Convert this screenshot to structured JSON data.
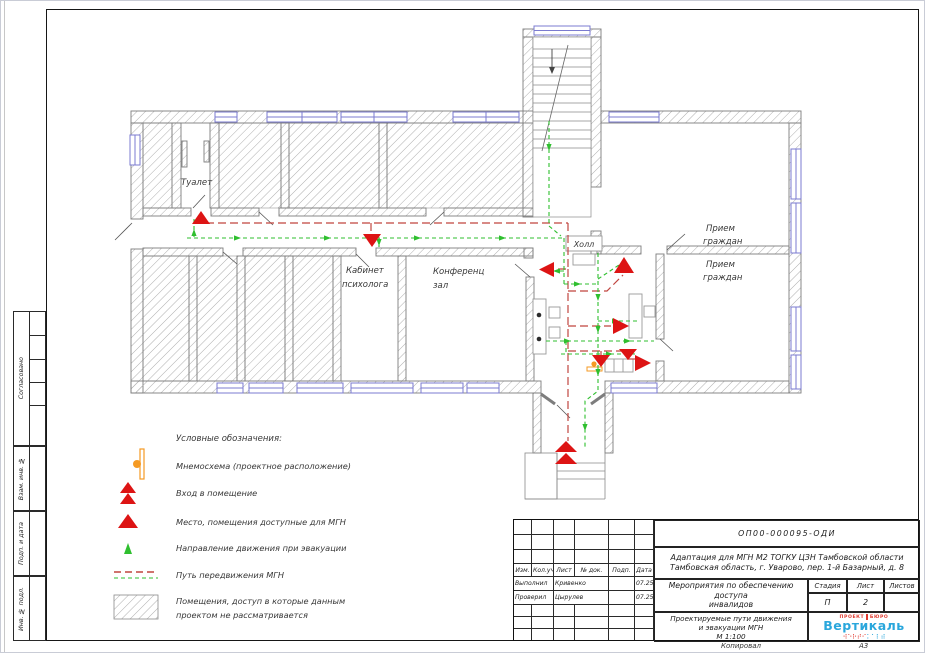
{
  "page": {
    "format": "А3",
    "copied": "Копировал"
  },
  "sidebar": {
    "approved": "Согласовано",
    "vzam": "Взам. инв. №",
    "podp": "Подп. и дата",
    "inv": "Инв. № подл."
  },
  "plan": {
    "rooms": {
      "toilet": "Туалет",
      "psych1": "Кабинет",
      "psych2": "психолога",
      "conf1": "Конференц",
      "conf2": "зал",
      "hall": "Холл",
      "rec1a": "Прием",
      "rec1b": "граждан",
      "rec2a": "Прием",
      "rec2b": "граждан"
    }
  },
  "legend": {
    "title": "Условные обозначения:",
    "items": [
      {
        "label": "Мнемосхема (проектное расположение)"
      },
      {
        "label": "Вход в помещение"
      },
      {
        "label": "Место, помещения доступные для МГН"
      },
      {
        "label": "Направление движения при эвакуации"
      },
      {
        "label": "Путь передвижения МГН"
      },
      {
        "label": "Помещения, доступ в которые данным",
        "label2": "проектом не рассматривается"
      }
    ]
  },
  "title_block": {
    "doc_number": "ОП00-000095-ОДИ",
    "project_line1": "Адаптация для МГН М2 ТОГКУ ЦЗН Тамбовской области",
    "project_line2": "Тамбовская область, г. Уварово, пер. 1-й Базарный, д. 8",
    "section_line1": "Мероприятия по обеспечению доступа",
    "section_line2": "инвалидов",
    "sheet_line1": "Проектируемые пути движения",
    "sheet_line2": "и эвакуации МГН",
    "scale": "М 1:100",
    "cols": {
      "izm": "Изм.",
      "kol": "Кол.уч.",
      "list": "Лист",
      "doc": "№ док.",
      "podp": "Подп.",
      "date": "Дата"
    },
    "stage": {
      "h1": "Стадия",
      "h2": "Лист",
      "h3": "Листов",
      "v1": "П",
      "v2": "2",
      "v3": ""
    },
    "rows": [
      {
        "role": "Выполнил",
        "name": "Кривенко",
        "date": "07.25"
      },
      {
        "role": "Проверил",
        "name": "Цырулев",
        "date": "07.25"
      }
    ],
    "logo": {
      "word1": "ПРОЕКТ",
      "word2": "БЮРО",
      "name": "Вертикаль",
      "braille_red": "⠺⠑⠗⠞⠊",
      "braille_blue": "⠅⠁⠇⠾"
    }
  },
  "colors": {
    "path_red": "#c0453f",
    "path_green": "#2fbf2f",
    "marker_red": "#dd1414",
    "window_blue": "#7b7bd0",
    "mnemo_orange": "#f59a23",
    "logo_blue": "#2aa7dc",
    "logo_red": "#e03a2f"
  }
}
